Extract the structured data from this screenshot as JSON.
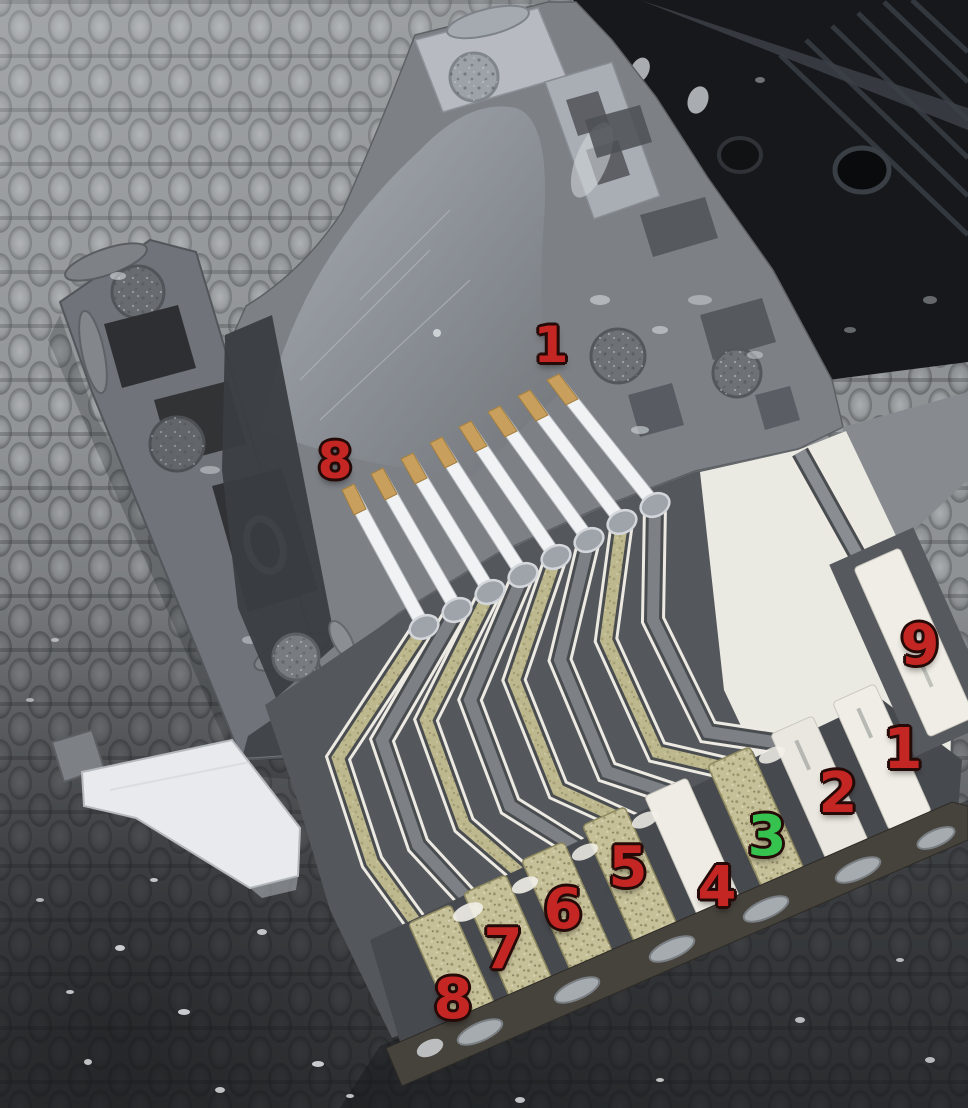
{
  "scene": {
    "subject": "Disassembled microSD-to-SD card adapter, opened shell showing internal spring pins and circuit traces",
    "background": "gray woven carpet, darker toward bottom",
    "objects": [
      "black adapter shell half (top right)",
      "gray adapter body with microSD slot channel",
      "left rail with lock-switch slots",
      "eight spring contact pins with gold tips",
      "solder joints",
      "zigzag brass and gray circuit traces",
      "nine SD card edge contact pads",
      "white lock slider tab",
      "dark card bottom edge with solder dabs"
    ]
  },
  "palette": {
    "annotation_red": "#c42623",
    "annotation_green": "#35c24f",
    "annotation_outline": "#250a08",
    "carpet_gray": "#8f9295",
    "adapter_gray": "#7d8186",
    "black_shell": "#16181b",
    "pin_white": "#f1f2f3",
    "pin_gold_tip": "#c89f5c",
    "trace_khaki": "#beb88e",
    "pad_cream": "#efede5",
    "bottom_edge_brown": "#46423c"
  },
  "annotations": {
    "items": [
      {
        "id": "pin1-top",
        "label": "1",
        "color": "#c42623",
        "x": 551,
        "y": 345,
        "size": 50
      },
      {
        "id": "pin8-top",
        "label": "8",
        "color": "#c42623",
        "x": 335,
        "y": 461,
        "size": 50
      },
      {
        "id": "pad9",
        "label": "9",
        "color": "#c42623",
        "x": 920,
        "y": 646,
        "size": 56
      },
      {
        "id": "pad1",
        "label": "1",
        "color": "#c42623",
        "x": 903,
        "y": 750,
        "size": 56
      },
      {
        "id": "pad2",
        "label": "2",
        "color": "#c42623",
        "x": 838,
        "y": 794,
        "size": 56
      },
      {
        "id": "pad3",
        "label": "3",
        "color": "#35c24f",
        "x": 767,
        "y": 837,
        "size": 56
      },
      {
        "id": "pad4",
        "label": "4",
        "color": "#c42623",
        "x": 717,
        "y": 888,
        "size": 56
      },
      {
        "id": "pad5",
        "label": "5",
        "color": "#c42623",
        "x": 628,
        "y": 868,
        "size": 56
      },
      {
        "id": "pad6",
        "label": "6",
        "color": "#c42623",
        "x": 563,
        "y": 910,
        "size": 56
      },
      {
        "id": "pad7",
        "label": "7",
        "color": "#c42623",
        "x": 503,
        "y": 950,
        "size": 56
      },
      {
        "id": "pad8",
        "label": "8",
        "color": "#c42623",
        "x": 453,
        "y": 1000,
        "size": 56
      }
    ]
  }
}
